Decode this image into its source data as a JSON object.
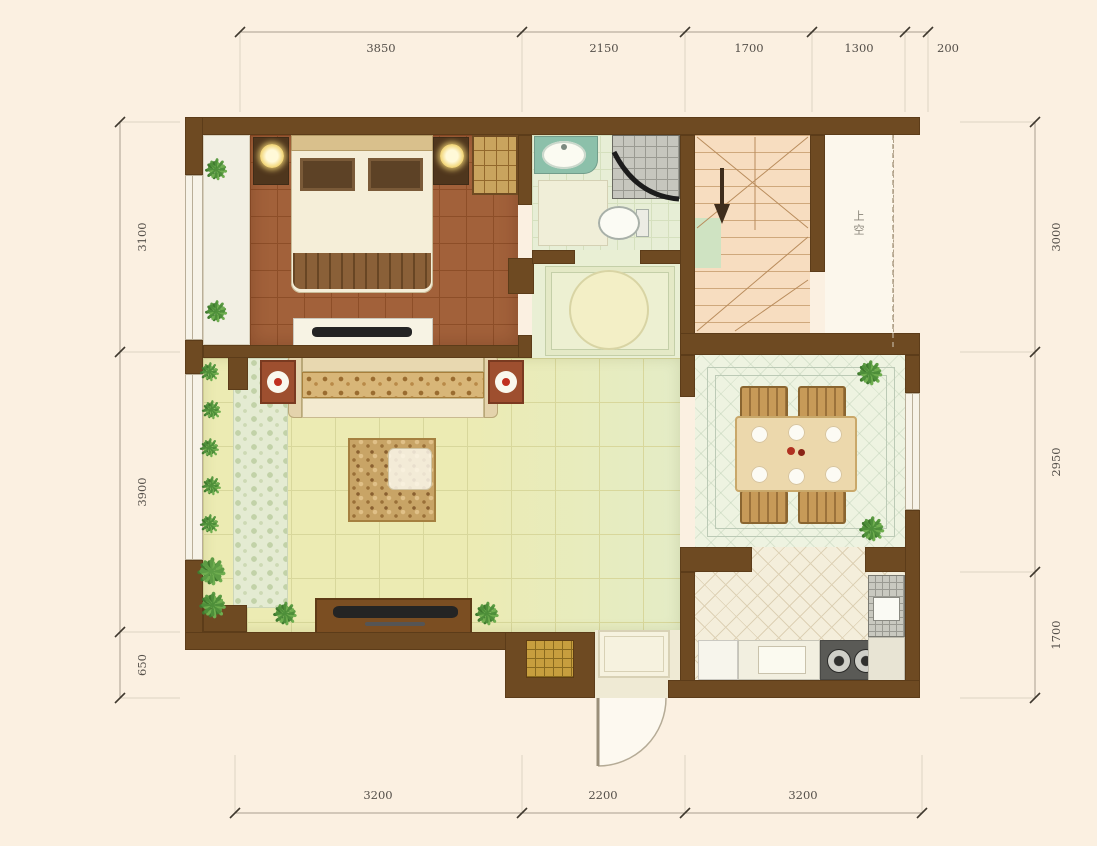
{
  "document": {
    "type": "residential floor plan",
    "units": "mm"
  },
  "dimensions": {
    "top": [
      "3850",
      "2150",
      "1700",
      "1300",
      "200"
    ],
    "bottom": [
      "3200",
      "2200",
      "3200"
    ],
    "left": [
      "3100",
      "3900",
      "650"
    ],
    "right": [
      "3000",
      "2950",
      "1700"
    ]
  },
  "annotations": {
    "stair_void_label": "上空"
  },
  "icons": {
    "plant": "❋"
  },
  "colors": {
    "background": "#fbf0e1",
    "wall": "#6e4a22",
    "bedroom_floor": "#a2613a",
    "living_floor": "#ebeab2",
    "bath_floor": "#e7eed6",
    "stair_floor": "#f7ddc0",
    "dining_floor": "#eef3e1",
    "kitchen_floor": "#f4eedb",
    "accent_red": "#b03020",
    "plant_green": "#4e8f3a"
  }
}
